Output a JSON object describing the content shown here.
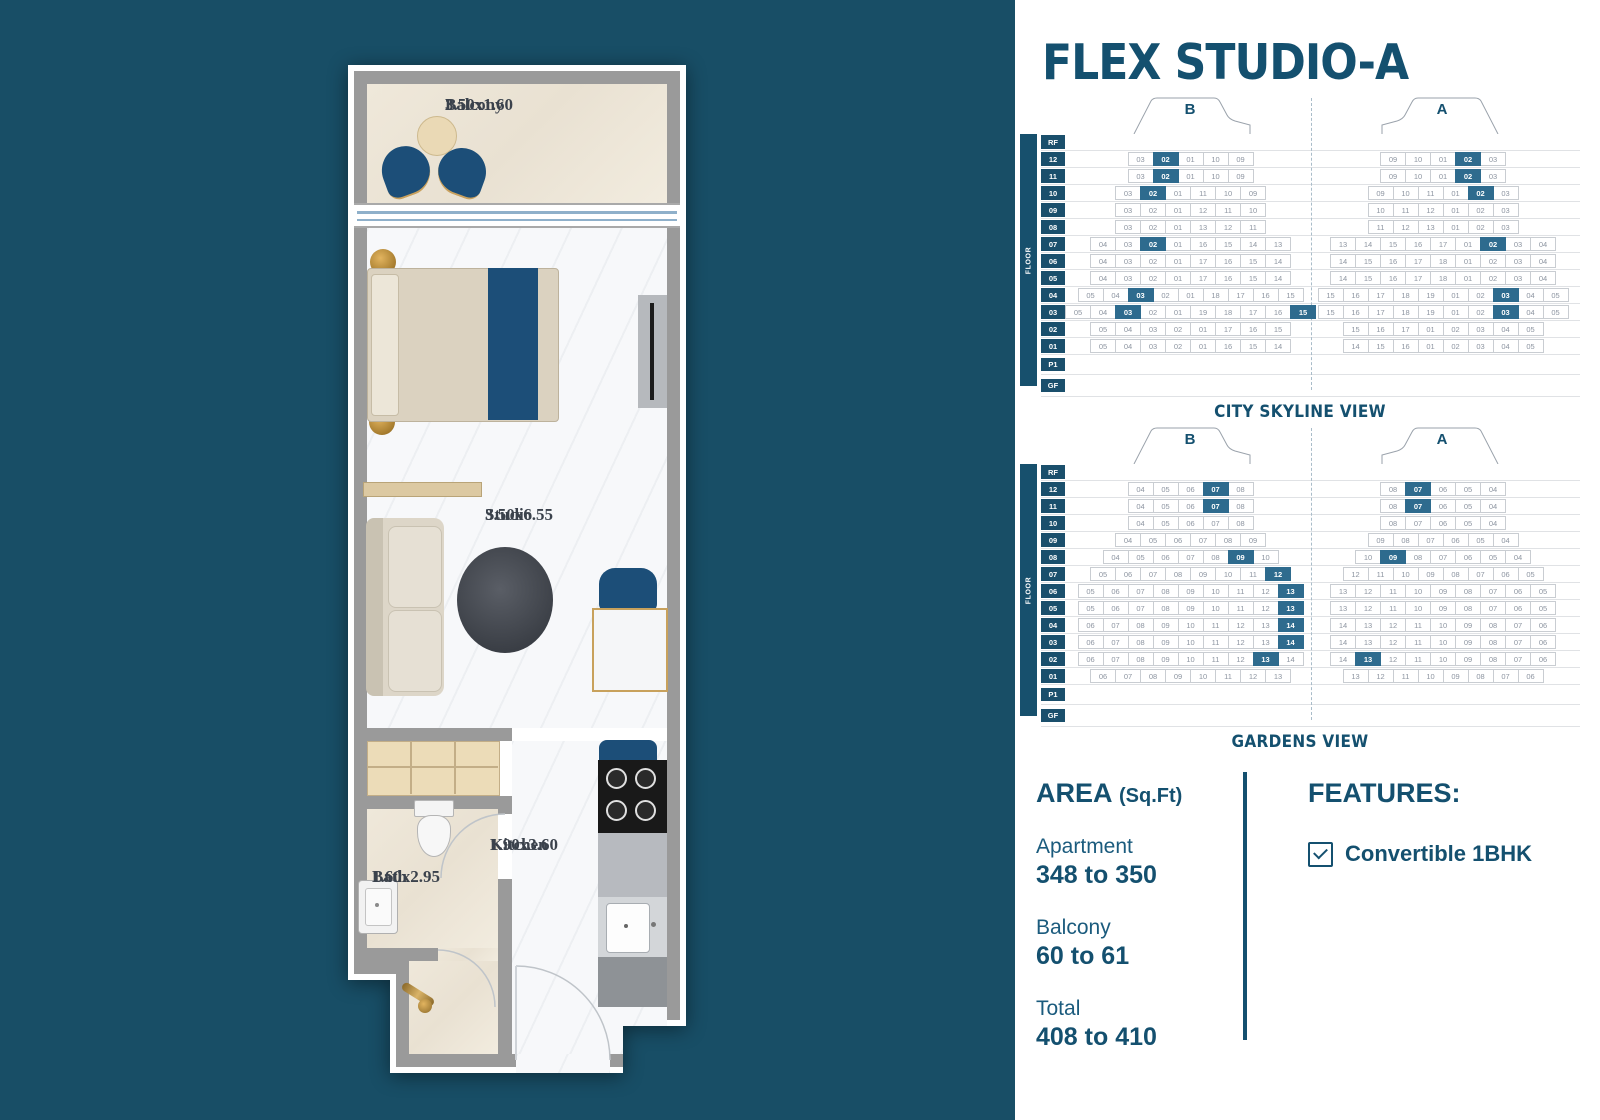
{
  "colors": {
    "background_teal": "#184E66",
    "accent_teal": "#14506F",
    "highlight_cell": "#2E6B8E",
    "plan_blue": "#1C4E78",
    "gold": "#C9A15E"
  },
  "title": "FLEX STUDIO-A",
  "floorplan": {
    "rooms": {
      "balcony": {
        "name": "Balcony",
        "dims": "3.50x1.60"
      },
      "studio": {
        "name": "Studio",
        "dims": "3.50x6.55"
      },
      "kitchen": {
        "name": "Kitchen",
        "dims": "1.90x3.60"
      },
      "bath": {
        "name": "Bath",
        "dims": "1.60x2.95"
      }
    }
  },
  "views": [
    {
      "caption": "CITY SKYLINE VIEW",
      "axis_label": "FLOOR",
      "wings": [
        "B",
        "A"
      ],
      "rows": [
        {
          "floor": "RF",
          "b": [],
          "a": []
        },
        {
          "floor": "12",
          "b": [
            "03",
            "02*",
            "01",
            "10",
            "09"
          ],
          "a": [
            "09",
            "10",
            "01",
            "02*",
            "03"
          ]
        },
        {
          "floor": "11",
          "b": [
            "03",
            "02*",
            "01",
            "10",
            "09"
          ],
          "a": [
            "09",
            "10",
            "01",
            "02*",
            "03"
          ]
        },
        {
          "floor": "10",
          "b": [
            "03",
            "02*",
            "01",
            "11",
            "10",
            "09"
          ],
          "a": [
            "09",
            "10",
            "11",
            "01",
            "02*",
            "03"
          ]
        },
        {
          "floor": "09",
          "b": [
            "03",
            "02",
            "01",
            "12",
            "11",
            "10"
          ],
          "a": [
            "10",
            "11",
            "12",
            "01",
            "02",
            "03"
          ]
        },
        {
          "floor": "08",
          "b": [
            "03",
            "02",
            "01",
            "13",
            "12",
            "11"
          ],
          "a": [
            "11",
            "12",
            "13",
            "01",
            "02",
            "03"
          ]
        },
        {
          "floor": "07",
          "b": [
            "04",
            "03",
            "02*",
            "01",
            "16",
            "15",
            "14",
            "13"
          ],
          "a": [
            "13",
            "14",
            "15",
            "16",
            "17",
            "01",
            "02*",
            "03",
            "04"
          ]
        },
        {
          "floor": "06",
          "b": [
            "04",
            "03",
            "02",
            "01",
            "17",
            "16",
            "15",
            "14"
          ],
          "a": [
            "14",
            "15",
            "16",
            "17",
            "18",
            "01",
            "02",
            "03",
            "04"
          ]
        },
        {
          "floor": "05",
          "b": [
            "04",
            "03",
            "02",
            "01",
            "17",
            "16",
            "15",
            "14"
          ],
          "a": [
            "14",
            "15",
            "16",
            "17",
            "18",
            "01",
            "02",
            "03",
            "04"
          ]
        },
        {
          "floor": "04",
          "b": [
            "05",
            "04",
            "03*",
            "02",
            "01",
            "18",
            "17",
            "16",
            "15"
          ],
          "a": [
            "15",
            "16",
            "17",
            "18",
            "19",
            "01",
            "02",
            "03*",
            "04",
            "05"
          ]
        },
        {
          "floor": "03",
          "b": [
            "05",
            "04",
            "03*",
            "02",
            "01",
            "19",
            "18",
            "17",
            "16",
            "15*"
          ],
          "a": [
            "15",
            "16",
            "17",
            "18",
            "19",
            "01",
            "02",
            "03*",
            "04",
            "05"
          ]
        },
        {
          "floor": "02",
          "b": [
            "05",
            "04",
            "03",
            "02",
            "01",
            "17",
            "16",
            "15"
          ],
          "a": [
            "15",
            "16",
            "17",
            "01",
            "02",
            "03",
            "04",
            "05"
          ]
        },
        {
          "floor": "01",
          "b": [
            "05",
            "04",
            "03",
            "02",
            "01",
            "16",
            "15",
            "14"
          ],
          "a": [
            "14",
            "15",
            "16",
            "01",
            "02",
            "03",
            "04",
            "05"
          ]
        },
        {
          "floor": "P1",
          "b": [],
          "a": []
        },
        {
          "floor": "GF",
          "b": [],
          "a": []
        }
      ]
    },
    {
      "caption": "GARDENS VIEW",
      "axis_label": "FLOOR",
      "wings": [
        "B",
        "A"
      ],
      "rows": [
        {
          "floor": "RF",
          "b": [],
          "a": []
        },
        {
          "floor": "12",
          "b": [
            "04",
            "05",
            "06",
            "07*",
            "08"
          ],
          "a": [
            "08",
            "07*",
            "06",
            "05",
            "04"
          ]
        },
        {
          "floor": "11",
          "b": [
            "04",
            "05",
            "06",
            "07*",
            "08"
          ],
          "a": [
            "08",
            "07*",
            "06",
            "05",
            "04"
          ]
        },
        {
          "floor": "10",
          "b": [
            "04",
            "05",
            "06",
            "07",
            "08"
          ],
          "a": [
            "08",
            "07",
            "06",
            "05",
            "04"
          ]
        },
        {
          "floor": "09",
          "b": [
            "04",
            "05",
            "06",
            "07",
            "08",
            "09"
          ],
          "a": [
            "09",
            "08",
            "07",
            "06",
            "05",
            "04"
          ]
        },
        {
          "floor": "08",
          "b": [
            "04",
            "05",
            "06",
            "07",
            "08",
            "09*",
            "10"
          ],
          "a": [
            "10",
            "09*",
            "08",
            "07",
            "06",
            "05",
            "04"
          ]
        },
        {
          "floor": "07",
          "b": [
            "05",
            "06",
            "07",
            "08",
            "09",
            "10",
            "11",
            "12*"
          ],
          "a": [
            "12",
            "11",
            "10",
            "09",
            "08",
            "07",
            "06",
            "05"
          ]
        },
        {
          "floor": "06",
          "b": [
            "05",
            "06",
            "07",
            "08",
            "09",
            "10",
            "11",
            "12",
            "13*"
          ],
          "a": [
            "13",
            "12",
            "11",
            "10",
            "09",
            "08",
            "07",
            "06",
            "05"
          ]
        },
        {
          "floor": "05",
          "b": [
            "05",
            "06",
            "07",
            "08",
            "09",
            "10",
            "11",
            "12",
            "13*"
          ],
          "a": [
            "13",
            "12",
            "11",
            "10",
            "09",
            "08",
            "07",
            "06",
            "05"
          ]
        },
        {
          "floor": "04",
          "b": [
            "06",
            "07",
            "08",
            "09",
            "10",
            "11",
            "12",
            "13",
            "14*"
          ],
          "a": [
            "14",
            "13",
            "12",
            "11",
            "10",
            "09",
            "08",
            "07",
            "06"
          ]
        },
        {
          "floor": "03",
          "b": [
            "06",
            "07",
            "08",
            "09",
            "10",
            "11",
            "12",
            "13",
            "14*"
          ],
          "a": [
            "14",
            "13",
            "12",
            "11",
            "10",
            "09",
            "08",
            "07",
            "06"
          ]
        },
        {
          "floor": "02",
          "b": [
            "06",
            "07",
            "08",
            "09",
            "10",
            "11",
            "12",
            "13*",
            "14"
          ],
          "a": [
            "14",
            "13*",
            "12",
            "11",
            "10",
            "09",
            "08",
            "07",
            "06"
          ]
        },
        {
          "floor": "01",
          "b": [
            "06",
            "07",
            "08",
            "09",
            "10",
            "11",
            "12",
            "13"
          ],
          "a": [
            "13",
            "12",
            "11",
            "10",
            "09",
            "08",
            "07",
            "06"
          ]
        },
        {
          "floor": "P1",
          "b": [],
          "a": []
        },
        {
          "floor": "GF",
          "b": [],
          "a": []
        }
      ]
    }
  ],
  "area": {
    "heading_main": "AREA ",
    "heading_unit": "(Sq.Ft)",
    "items": [
      {
        "label": "Apartment",
        "value": "348 to 350"
      },
      {
        "label": "Balcony",
        "value": "60 to 61"
      },
      {
        "label": "Total",
        "value": "408 to 410"
      }
    ]
  },
  "features": {
    "heading": "FEATURES:",
    "items": [
      {
        "label": "Convertible 1BHK",
        "checked": true
      }
    ]
  }
}
